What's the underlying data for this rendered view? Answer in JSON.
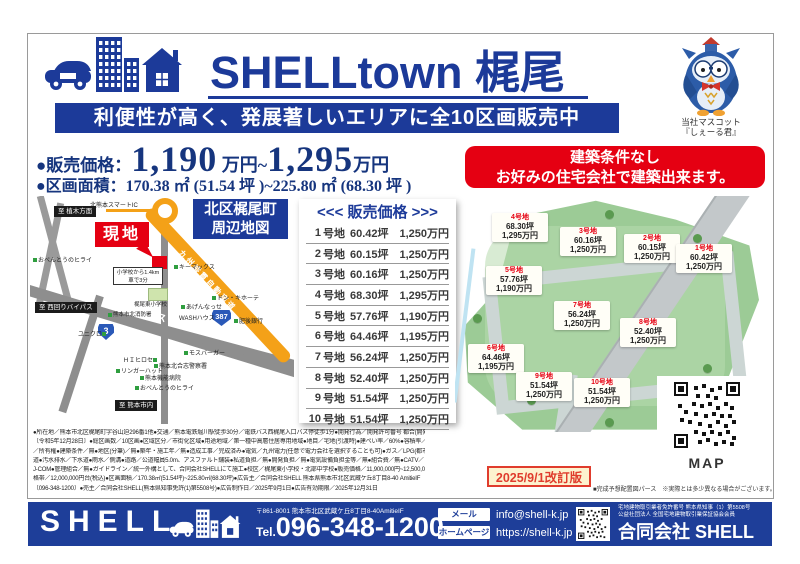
{
  "colors": {
    "navy": "#1c3a99",
    "red": "#e50012",
    "orange": "#f4a118",
    "green": "#9ccb96"
  },
  "header": {
    "title": "SHELLtown 梶尾",
    "tagline": "利便性が高く、発展著しいエリアに全10区画販売中",
    "mascot_caption1": "当社マスコット",
    "mascot_caption2": "『しぇーる君』"
  },
  "pricing": {
    "label1": "●販売価格：",
    "big1": "1,190",
    "mid": " 万円~",
    "big2": "1,295",
    "tail": "万円",
    "label2": "●区画面積：",
    "area": "170.38 ㎡ (51.54 坪 )~225.80 ㎡ (68.30 坪 )"
  },
  "condition_banner": {
    "line1": "建築条件なし",
    "line2": "お好みの住宅会社で建築出来ます。"
  },
  "map": {
    "title1": "北区梶尾町",
    "title2": "周辺地図",
    "genchi": "現地",
    "ic": "北熊本スマートIC",
    "expressway": "九州縦貫自動車道",
    "bypass": "北バイパス",
    "route3": "3",
    "route387": "387",
    "dir_north": "至 植木方面",
    "dir_west": "至 西回りバイパス",
    "dir_south": "至 熊本市内",
    "info_line1": "小学校から1.4km",
    "info_line2": "車で3分",
    "school": "梶尾東小学校",
    "pois": [
      "おべんとうのヒライ",
      "キーマックス",
      "あげんなっせ",
      "WASHハウス",
      "ドン・キホーテ",
      "肥後銀行",
      "熊本市北消防署",
      "ユニクロ",
      "ＨＩヒロセ",
      "リンガーハット",
      "モスバーガー",
      "熊本北合志警察署",
      "熊本機能病院",
      "おべんとうのヒライ"
    ]
  },
  "price_table": {
    "title": "<<< 販売価格 >>>",
    "unit_label": "号地",
    "rows": [
      {
        "no": "1",
        "tsubo": "60.42坪",
        "price": "1,250万円"
      },
      {
        "no": "2",
        "tsubo": "60.15坪",
        "price": "1,250万円"
      },
      {
        "no": "3",
        "tsubo": "60.16坪",
        "price": "1,250万円"
      },
      {
        "no": "4",
        "tsubo": "68.30坪",
        "price": "1,295万円"
      },
      {
        "no": "5",
        "tsubo": "57.76坪",
        "price": "1,190万円"
      },
      {
        "no": "6",
        "tsubo": "64.46坪",
        "price": "1,195万円"
      },
      {
        "no": "7",
        "tsubo": "56.24坪",
        "price": "1,250万円"
      },
      {
        "no": "8",
        "tsubo": "52.40坪",
        "price": "1,250万円"
      },
      {
        "no": "9",
        "tsubo": "51.54坪",
        "price": "1,250万円"
      },
      {
        "no": "10",
        "tsubo": "51.54坪",
        "price": "1,250万円"
      }
    ]
  },
  "site_plan": {
    "lots": [
      {
        "name": "1号地",
        "tsubo": "60.42坪",
        "price": "1,250万円"
      },
      {
        "name": "2号地",
        "tsubo": "60.15坪",
        "price": "1,250万円"
      },
      {
        "name": "3号地",
        "tsubo": "60.16坪",
        "price": "1,250万円"
      },
      {
        "name": "4号地",
        "tsubo": "68.30坪",
        "price": "1,295万円"
      },
      {
        "name": "5号地",
        "tsubo": "57.76坪",
        "price": "1,190万円"
      },
      {
        "name": "6号地",
        "tsubo": "64.46坪",
        "price": "1,195万円"
      },
      {
        "name": "7号地",
        "tsubo": "56.24坪",
        "price": "1,250万円"
      },
      {
        "name": "8号地",
        "tsubo": "52.40坪",
        "price": "1,250万円"
      },
      {
        "name": "9号地",
        "tsubo": "51.54坪",
        "price": "1,250万円"
      },
      {
        "name": "10号地",
        "tsubo": "51.54坪",
        "price": "1,250万円"
      }
    ],
    "qr_label": "MAP",
    "revision": "2025/9/1改訂版",
    "note": "■完成予想配置図パース　※実際とは多少異なる場合がございます。"
  },
  "fine_print": {
    "lines": [
      "●所在地／熊本市北区梶尾町字谷山迫296番1他●交通／熊本電鉄堀川駅徒歩30分／電鉄バス西梶尾入口バス停徒歩1分●開発行為／開発許可番号 都合(開発)第2023-22号",
      "〔令和5年12月28日〕●総区画数／10区画●区域区分／市街化区域●用途地域／第一種中高層住居専用地域●地目／宅地(引渡時)●建ぺい率／60%●容積率／150%●権利",
      "／所有権●建築条件／無●地区(分筆)／無●築年・施工年／無●造成工事／完成済み●電気／九州電力(任意で電力会社を選択することも可)●ガス／LPG(都市ガスは無)●水",
      "道●汚水排水／下水道●雨水／側溝●道路／公道幅員5.0m、アスファルト舗装●私道負担／無●開発負担／無●電気設備負担金等／無●組合費／無●CATV／",
      "J-COM●管理組合／無●ガイドライン／統一外構として、合同会社SHELLにて施工●校区／梶尾東小学校・北部中学校●販売価格／11,900,000円~12,500,000円●価",
      "格帯／12,000,000円台(税込)●区画面積／170.38㎡(51.54坪)~225.80㎡(68.30坪)●広告主／合同会社SHELL 熊本県熊本市北区武蔵ケ丘8丁目8-40 AmitieIF",
      "〔096-348-1200〕●売主／合同会社SHELL(熊本県知事免許(1)第5508号)●広告制作日／2025年9月1日●広告有効期限／2025年12月31日"
    ]
  },
  "footer": {
    "brand": "SHELL",
    "address": "〒861-8001 熊本市北区武蔵ケ丘8丁目8-40AmitieIF",
    "tel_prefix": "Tel.",
    "tel": "096-348-1200",
    "mail_label": "メール",
    "mail": "info@shell-k.jp",
    "web_label": "ホームページ",
    "web": "https://shell-k.jp",
    "license1": "宅地建物取引業者免許番号 熊本県知事（1）第5508号",
    "license2": "公益社団法人 全国宅地建物取引業保証協会会員",
    "company": "合同会社 SHELL"
  }
}
